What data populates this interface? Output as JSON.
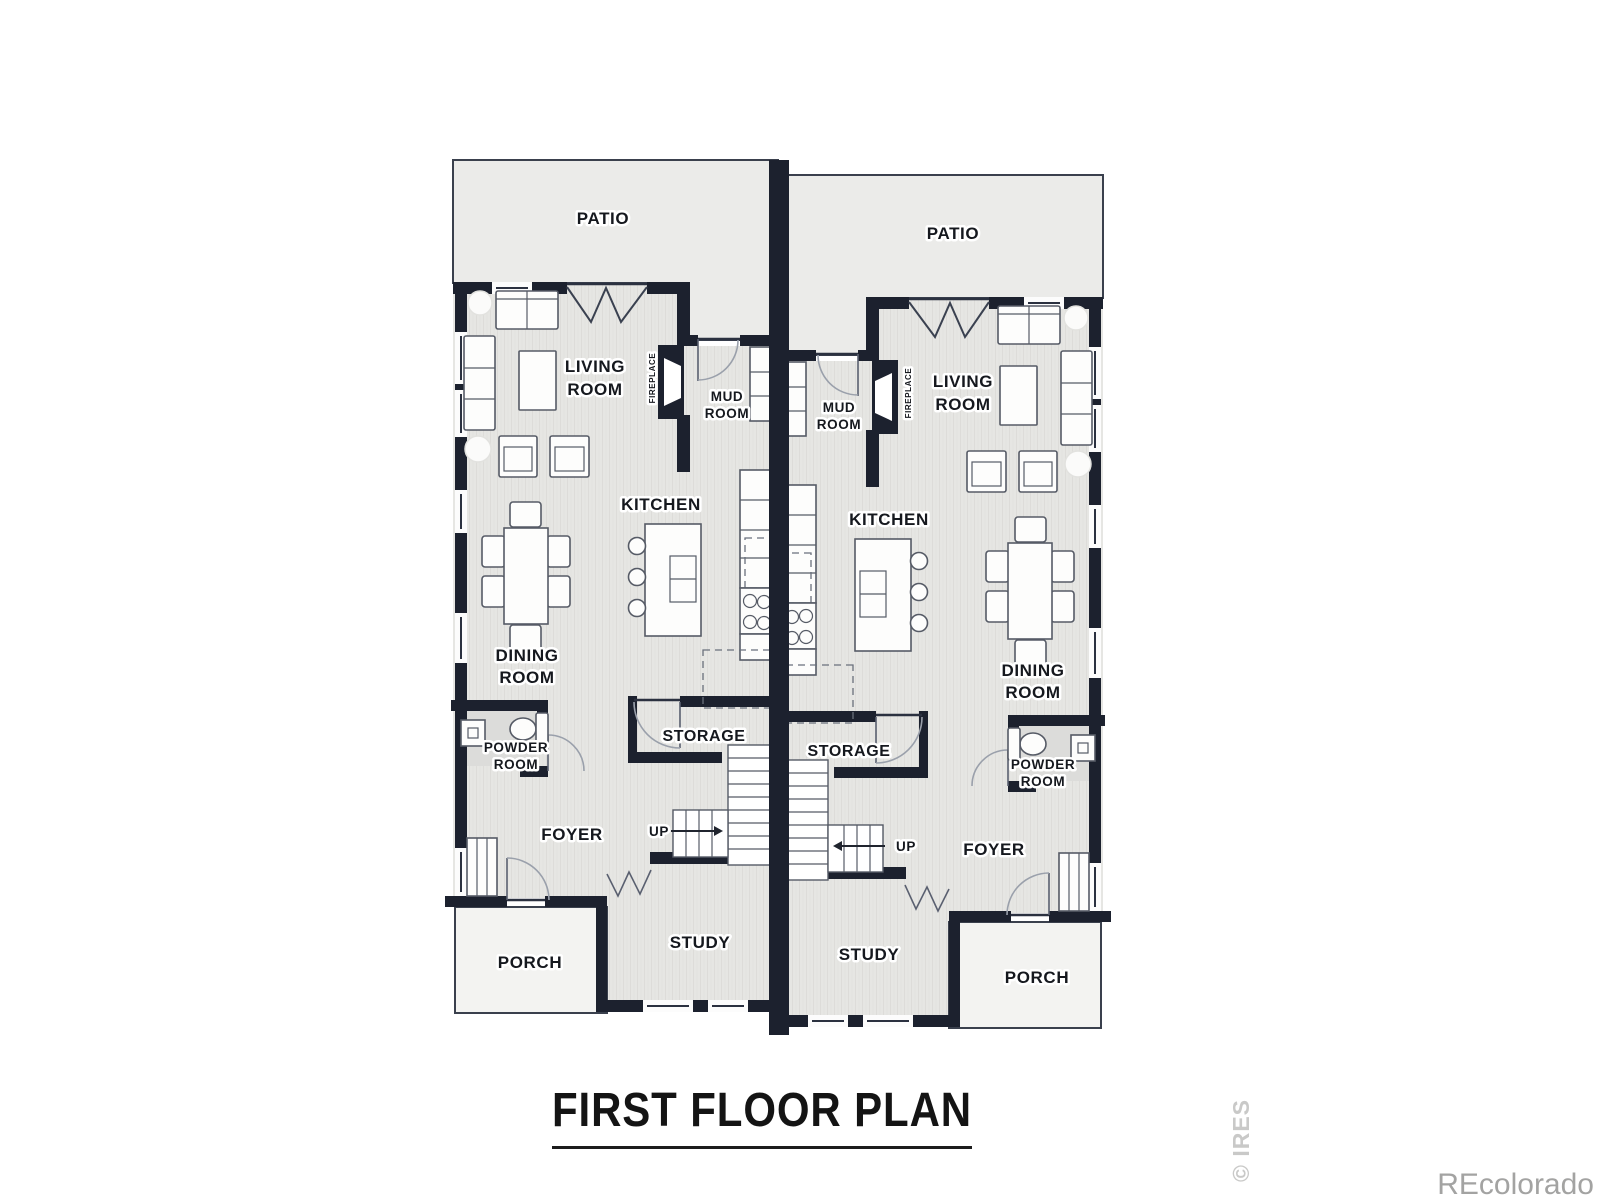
{
  "title": "FIRST FLOOR PLAN",
  "watermarks": {
    "side": "© IRES",
    "brand": "REcolorado"
  },
  "units": {
    "left": {
      "patio": "PATIO",
      "living": [
        "LIVING",
        "ROOM"
      ],
      "fireplace": "FIREPLACE",
      "mud": [
        "MUD",
        "ROOM"
      ],
      "kitchen": "KITCHEN",
      "dining": [
        "DINING",
        "ROOM"
      ],
      "powder": [
        "POWDER",
        "ROOM"
      ],
      "storage": "STORAGE",
      "up": "UP",
      "foyer": "FOYER",
      "study": "STUDY",
      "porch": "PORCH"
    },
    "right": {
      "patio": "PATIO",
      "living": [
        "LIVING",
        "ROOM"
      ],
      "fireplace": "FIREPLACE",
      "mud": [
        "MUD",
        "ROOM"
      ],
      "kitchen": "KITCHEN",
      "dining": [
        "DINING",
        "ROOM"
      ],
      "powder": [
        "POWDER",
        "ROOM"
      ],
      "storage": "STORAGE",
      "up": "UP",
      "foyer": "FOYER",
      "study": "STUDY",
      "porch": "PORCH"
    }
  },
  "colors": {
    "wall": "#1c212e",
    "floor": "#e6e6e3",
    "floor_stripe": "#dddcd9",
    "patio": "#ebebe9",
    "porch": "#f3f3f1",
    "label": "#15181e",
    "furniture_outline": "#565b66",
    "watermark_side": "#c9c9c8",
    "watermark_brand": "#a3a3a2"
  }
}
